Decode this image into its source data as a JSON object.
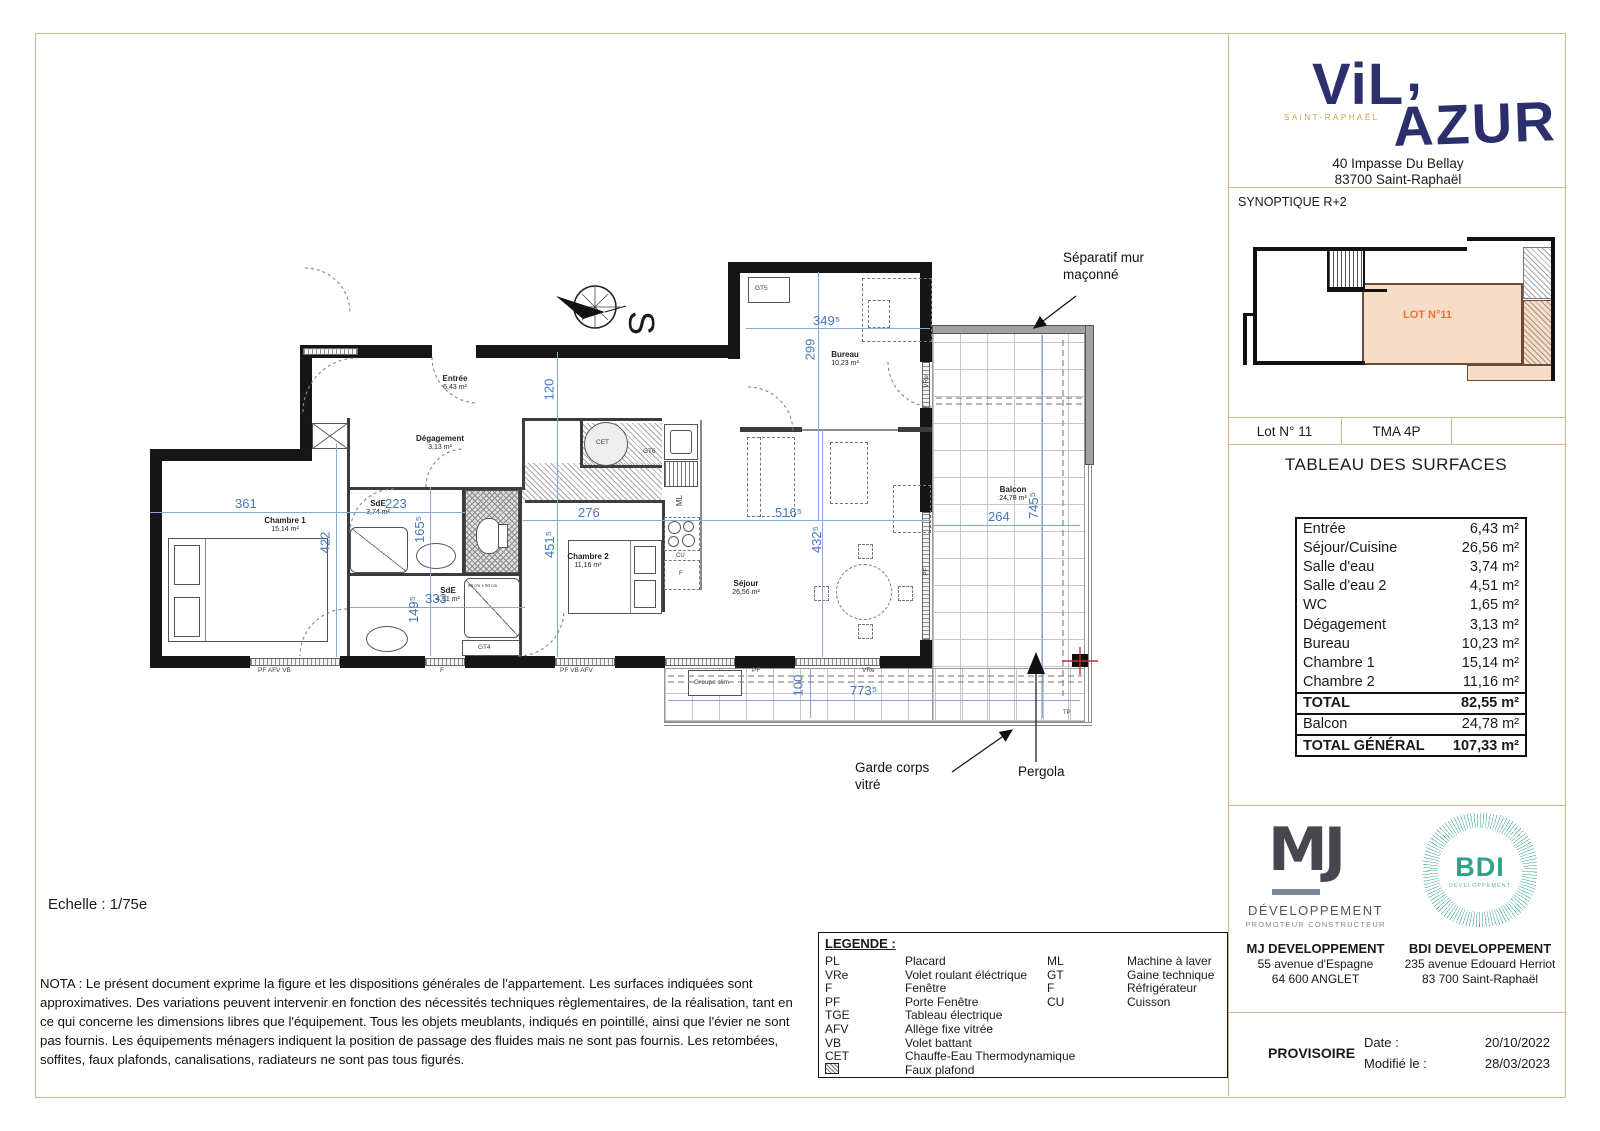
{
  "brand": {
    "name_left": "ViL",
    "apostrophe": "’",
    "name_right": "AZUR",
    "subtitle": "SAINT-RAPHAËL",
    "address1": "40 Impasse Du Bellay",
    "address2": "83700 Saint-Raphaël"
  },
  "synoptique": {
    "title": "SYNOPTIQUE R+2",
    "lot_highlight": "LOT N°11",
    "cells": [
      "Lot N° 11",
      "TMA 4P",
      ""
    ]
  },
  "surfaces": {
    "title": "TABLEAU DES SURFACES",
    "rows": [
      [
        "Entrée",
        "6,43 m²"
      ],
      [
        "Séjour/Cuisine",
        "26,56 m²"
      ],
      [
        "Salle d'eau",
        "3,74 m²"
      ],
      [
        "Salle d'eau 2",
        "4,51 m²"
      ],
      [
        "WC",
        "1,65 m²"
      ],
      [
        "Dégagement",
        "3,13 m²"
      ],
      [
        "Bureau",
        "10,23 m²"
      ],
      [
        "Chambre 1",
        "15,14 m²"
      ],
      [
        "Chambre 2",
        "11,16 m²"
      ]
    ],
    "total": [
      "TOTAL",
      "82,55 m²"
    ],
    "balcon": [
      "Balcon",
      "24,78 m²"
    ],
    "total_general": [
      "TOTAL GÉNÉRAL",
      "107,33 m²"
    ]
  },
  "developers": {
    "mj": {
      "logo_text": "MJ",
      "logo_line1": "DÉVELOPPEMENT",
      "logo_line2": "PROMOTEUR  CONSTRUCTEUR",
      "name": "MJ DEVELOPPEMENT",
      "addr1": "55 avenue d'Espagne",
      "addr2": "64 600 ANGLET"
    },
    "bdi": {
      "logo_text": "BDI",
      "logo_sub": "DÉVELOPPEMENT",
      "name": "BDI DEVELOPPEMENT",
      "addr1": "235 avenue Edouard Herriot",
      "addr2": "83 700 Saint-Raphaël"
    }
  },
  "status": {
    "label": "PROVISOIRE",
    "date_label": "Date :",
    "date_value": "20/10/2022",
    "modified_label": "Modifié le :",
    "modified_value": "28/03/2023"
  },
  "sheet": {
    "echelle": "Echelle : 1/75e",
    "nota": "NOTA : Le présent document exprime la figure et les dispositions générales de l'appartement. Les surfaces indiquées sont approximatives. Des variations peuvent intervenir en fonction des nécessités techniques règlementaires, de la réalisation, tant en ce qui concerne les dimensions libres que l'équipement. Tous les objets meublants, indiqués en pointillé, ainsi que l'évier ne sont pas fournis. Les équipements ménagers indiquent la position de passage des fluides mais ne sont pas fournis. Les retombées, soffites, faux plafonds, canalisations, radiateurs ne sont pas tous figurés."
  },
  "legend": {
    "title": "LEGENDE :",
    "left": [
      [
        "PL",
        "Placard"
      ],
      [
        "VRe",
        "Volet roulant éléctrique"
      ],
      [
        "F",
        "Fenêtre"
      ],
      [
        "PF",
        "Porte Fenêtre"
      ],
      [
        "TGE",
        "Tableau électrique"
      ],
      [
        "AFV",
        "Allège fixe vitrée"
      ],
      [
        "VB",
        "Volet battant"
      ],
      [
        "CET",
        "Chauffe-Eau Thermodynamique"
      ]
    ],
    "faux_plafond": "Faux plafond",
    "right": [
      [
        "ML",
        "Machine à laver"
      ],
      [
        "GT",
        "Gaine technique"
      ],
      [
        "F",
        "Réfrigérateur"
      ],
      [
        "CU",
        "Cuisson"
      ]
    ]
  },
  "plan": {
    "north": "S",
    "rooms": [
      {
        "name": "Entrée",
        "area": "6,43 m²"
      },
      {
        "name": "Dégagement",
        "area": "3,13 m²"
      },
      {
        "name": "Chambre 1",
        "area": "15,14 m²"
      },
      {
        "name": "SdE",
        "area": "3,74 m²"
      },
      {
        "name": "SdE",
        "area": "4,51 m²"
      },
      {
        "name": "Chambre 2",
        "area": "11,16 m²"
      },
      {
        "name": "Séjour",
        "area": "26,56 m²"
      },
      {
        "name": "Bureau",
        "area": "10,23 m²"
      },
      {
        "name": "Balcon",
        "area": "24,78 m²"
      }
    ],
    "dims": [
      "361",
      "223",
      "422",
      "165⁵",
      "333",
      "149⁵",
      "276",
      "451⁵",
      "120",
      "299",
      "349⁵",
      "516⁵",
      "432⁵",
      "264",
      "745⁵",
      "100",
      "773⁵"
    ],
    "equipment": {
      "gt5": "GT5",
      "gt6": "GT6",
      "gt4": "GT4",
      "cet": "CET",
      "ml": "ML",
      "cu": "CU",
      "fridge": "F",
      "tp": "TP",
      "groupe_clim": "Groupe clim",
      "shower_size": "90 cm x 90 cm"
    },
    "wall_labels": {
      "w1": "PF   AFV   VB",
      "w2": "F",
      "w3": "PF   VB   AFV",
      "w4": "PF",
      "w5": "VRe",
      "w6": "VRe",
      "w7": "PF"
    },
    "annotations": {
      "separatif1": "Séparatif mur",
      "separatif2": "maçonné",
      "garde1": "Garde corps",
      "garde2": "vitré",
      "pergola": "Pergola"
    }
  }
}
